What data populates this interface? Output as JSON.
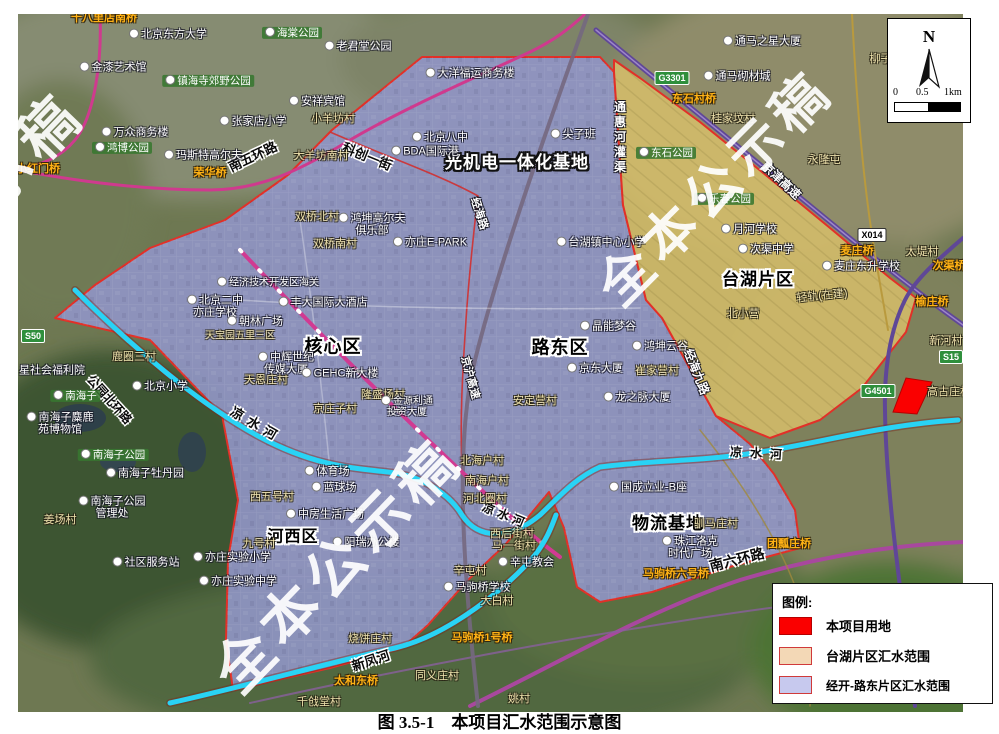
{
  "figure": {
    "caption": "图 3.5-1　本项目汇水范围示意图"
  },
  "map": {
    "scale": {
      "north": "N",
      "ticks": [
        "0",
        "0.5",
        "1km"
      ]
    },
    "legend": {
      "title": "图例:",
      "items": [
        {
          "label": "本项目用地",
          "color": "#fa0000",
          "border": "#b50000"
        },
        {
          "label": "台湖片区汇水范围",
          "color": "#f3d8b6",
          "border": "#d03a3a"
        },
        {
          "label": "经开-路东片区汇水范围",
          "color": "#c7c9ee",
          "border": "#d03a3a"
        }
      ]
    },
    "badges": [
      {
        "t": "S50",
        "x": 33,
        "y": 336,
        "c": "#2f8f3c",
        "tc": "#fff"
      },
      {
        "t": "G3301",
        "x": 672,
        "y": 78,
        "c": "#2f8f3c",
        "tc": "#fff"
      },
      {
        "t": "X014",
        "x": 872,
        "y": 235,
        "c": "#ffffff",
        "tc": "#000"
      },
      {
        "t": "G4501",
        "x": 878,
        "y": 391,
        "c": "#2f8f3c",
        "tc": "#fff"
      },
      {
        "t": "S15",
        "x": 951,
        "y": 357,
        "c": "#2f8f3c",
        "tc": "#fff"
      }
    ],
    "labels": [
      {
        "t": "光机电一体化基地",
        "x": 517,
        "y": 163,
        "s": "zonew",
        "fs": 17
      },
      {
        "t": "核心区",
        "x": 333,
        "y": 347,
        "s": "zone",
        "fs": 18
      },
      {
        "t": "路东区",
        "x": 560,
        "y": 348,
        "s": "zone",
        "fs": 18
      },
      {
        "t": "台湖片区",
        "x": 758,
        "y": 280,
        "s": "zone",
        "fs": 17
      },
      {
        "t": "河西区",
        "x": 293,
        "y": 537,
        "s": "zone",
        "fs": 16
      },
      {
        "t": "物流基地",
        "x": 668,
        "y": 524,
        "s": "zone",
        "fs": 17
      },
      {
        "t": "南五环路",
        "x": 253,
        "y": 157,
        "s": "road",
        "r": -25
      },
      {
        "t": "科创一街",
        "x": 367,
        "y": 157,
        "s": "road",
        "r": 22
      },
      {
        "t": "南六环路",
        "x": 737,
        "y": 560,
        "s": "road",
        "r": -14,
        "fs": 14
      },
      {
        "t": "公园北环路",
        "x": 109,
        "y": 400,
        "s": "road",
        "r": 48,
        "fs": 12
      },
      {
        "t": "新凤河",
        "x": 371,
        "y": 661,
        "s": "road",
        "r": -18
      },
      {
        "t": "凉水河",
        "x": 256,
        "y": 425,
        "s": "road",
        "r": 30,
        "ls": 6
      },
      {
        "t": "凉水河",
        "x": 505,
        "y": 516,
        "s": "road",
        "r": 22,
        "fs": 12,
        "ls": 4
      },
      {
        "t": "凉水河",
        "x": 760,
        "y": 454,
        "s": "road",
        "r": 3,
        "fs": 12,
        "ls": 8
      },
      {
        "t": "京津高速",
        "x": 781,
        "y": 181,
        "s": "roadw",
        "r": 43
      },
      {
        "t": "京沪高速",
        "x": 469,
        "y": 378,
        "s": "roadw",
        "r": 75,
        "fs": 11
      },
      {
        "t": "经海路",
        "x": 478,
        "y": 214,
        "s": "roadw",
        "r": 72,
        "fs": 11
      },
      {
        "t": "经海九路",
        "x": 696,
        "y": 372,
        "s": "roadw",
        "r": 68,
        "fs": 12
      },
      {
        "t": "通惠河灌渠",
        "x": 619,
        "y": 138,
        "s": "vroad",
        "fs": 12
      },
      {
        "t": "小红门桥",
        "x": 38,
        "y": 170,
        "s": "bridge"
      },
      {
        "t": "十八里店南桥",
        "x": 104,
        "y": 19,
        "s": "bridge"
      },
      {
        "t": "荣华桥",
        "x": 210,
        "y": 174,
        "s": "bridge"
      },
      {
        "t": "东石村桥",
        "x": 694,
        "y": 100,
        "s": "bridge"
      },
      {
        "t": "麦庄桥",
        "x": 857,
        "y": 252,
        "s": "bridge"
      },
      {
        "t": "次渠桥",
        "x": 949,
        "y": 267,
        "s": "bridge"
      },
      {
        "t": "榆庄桥",
        "x": 932,
        "y": 303,
        "s": "bridge"
      },
      {
        "t": "马驹桥1号桥",
        "x": 482,
        "y": 639,
        "s": "bridge"
      },
      {
        "t": "太和东桥",
        "x": 356,
        "y": 682,
        "s": "bridge"
      },
      {
        "t": "马驹桥六号桥",
        "x": 676,
        "y": 575,
        "s": "bridge"
      },
      {
        "t": "团瓢庄桥",
        "x": 789,
        "y": 545,
        "s": "bridge"
      },
      {
        "t": "小羊坊村",
        "x": 333,
        "y": 120,
        "s": "village"
      },
      {
        "t": "大羊坊南村",
        "x": 321,
        "y": 157,
        "s": "village"
      },
      {
        "t": "双桥北村",
        "x": 317,
        "y": 218,
        "s": "village"
      },
      {
        "t": "双桥南村",
        "x": 335,
        "y": 245,
        "s": "village"
      },
      {
        "t": "天宝园五里三区",
        "x": 240,
        "y": 337,
        "s": "village",
        "fs": 10
      },
      {
        "t": "天恩庄村",
        "x": 266,
        "y": 381,
        "s": "village"
      },
      {
        "t": "京庄子村",
        "x": 335,
        "y": 410,
        "s": "village"
      },
      {
        "t": "隆盛场村",
        "x": 383,
        "y": 396,
        "s": "village"
      },
      {
        "t": "崔家营村",
        "x": 657,
        "y": 372,
        "s": "village"
      },
      {
        "t": "安定营村",
        "x": 535,
        "y": 402,
        "s": "village"
      },
      {
        "t": "北海户村",
        "x": 482,
        "y": 462,
        "s": "village"
      },
      {
        "t": "南海户村",
        "x": 487,
        "y": 482,
        "s": "village"
      },
      {
        "t": "河北圈村",
        "x": 485,
        "y": 500,
        "s": "village"
      },
      {
        "t": "西后街村",
        "x": 512,
        "y": 535,
        "s": "village"
      },
      {
        "t": "马一街村",
        "x": 514,
        "y": 547,
        "s": "village"
      },
      {
        "t": "辛屯村",
        "x": 470,
        "y": 572,
        "s": "village"
      },
      {
        "t": "大白村",
        "x": 497,
        "y": 602,
        "s": "village"
      },
      {
        "t": "同义庄村",
        "x": 437,
        "y": 677,
        "s": "village"
      },
      {
        "t": "姚村",
        "x": 519,
        "y": 700,
        "s": "village"
      },
      {
        "t": "千戗堂村",
        "x": 319,
        "y": 703,
        "s": "village"
      },
      {
        "t": "烧饼庄村",
        "x": 370,
        "y": 640,
        "s": "village"
      },
      {
        "t": "西五号村",
        "x": 272,
        "y": 498,
        "s": "village"
      },
      {
        "t": "九号村",
        "x": 259,
        "y": 545,
        "s": "village"
      },
      {
        "t": "驯马庄村",
        "x": 716,
        "y": 525,
        "s": "village"
      },
      {
        "t": "桂家坟村",
        "x": 733,
        "y": 120,
        "s": "village"
      },
      {
        "t": "永隆屯",
        "x": 824,
        "y": 161,
        "s": "village"
      },
      {
        "t": "柳子村",
        "x": 886,
        "y": 60,
        "s": "village"
      },
      {
        "t": "太堤村",
        "x": 922,
        "y": 253,
        "s": "village"
      },
      {
        "t": "新河村",
        "x": 946,
        "y": 342,
        "s": "village"
      },
      {
        "t": "高古庄村",
        "x": 949,
        "y": 393,
        "s": "village"
      },
      {
        "t": "鹿圈三村",
        "x": 134,
        "y": 358,
        "s": "village"
      },
      {
        "t": "姜场村",
        "x": 60,
        "y": 521,
        "s": "village"
      },
      {
        "t": "北小营",
        "x": 743,
        "y": 315,
        "s": "village"
      },
      {
        "t": "轻轨(在建)",
        "x": 822,
        "y": 297,
        "s": "village",
        "r": -6
      },
      {
        "t": "北京东方大学",
        "x": 168,
        "y": 35,
        "s": "poi"
      },
      {
        "t": "金漆艺术馆",
        "x": 113,
        "y": 68,
        "s": "poi"
      },
      {
        "t": "安祥宾馆",
        "x": 317,
        "y": 102,
        "s": "poi"
      },
      {
        "t": "张家店小学",
        "x": 253,
        "y": 122,
        "s": "poi"
      },
      {
        "t": "万众商务楼",
        "x": 135,
        "y": 133,
        "s": "poi"
      },
      {
        "t": "玛斯特高尔夫",
        "x": 203,
        "y": 156,
        "s": "poi"
      },
      {
        "t": "老君堂公园",
        "x": 358,
        "y": 47,
        "s": "poi"
      },
      {
        "t": "大洋福运商务楼",
        "x": 470,
        "y": 74,
        "s": "poi"
      },
      {
        "t": "北京八中",
        "x": 440,
        "y": 138,
        "s": "poi"
      },
      {
        "t": "BDA国际港",
        "x": 425,
        "y": 152,
        "s": "poi"
      },
      {
        "t": "尖子班",
        "x": 573,
        "y": 135,
        "s": "poi"
      },
      {
        "t": "亦庄E·PARK",
        "x": 430,
        "y": 243,
        "s": "poi"
      },
      {
        "t": "鸿坤高尔夫\n俱乐部",
        "x": 372,
        "y": 225,
        "s": "poi"
      },
      {
        "t": "经济技术开发区海关",
        "x": 268,
        "y": 283,
        "s": "poi",
        "fs": 10
      },
      {
        "t": "北京二中\n亦庄学校",
        "x": 215,
        "y": 307,
        "s": "poi"
      },
      {
        "t": "朝林广场",
        "x": 255,
        "y": 322,
        "s": "poi"
      },
      {
        "t": "丰大国际大酒店",
        "x": 323,
        "y": 303,
        "s": "poi"
      },
      {
        "t": "中辉世纪\n传媒大厦",
        "x": 286,
        "y": 364,
        "s": "poi"
      },
      {
        "t": "GEHC新大楼",
        "x": 340,
        "y": 374,
        "s": "poi"
      },
      {
        "t": "金源利通\n投资大厦",
        "x": 407,
        "y": 407,
        "s": "poi",
        "fs": 10
      },
      {
        "t": "北京小学",
        "x": 160,
        "y": 387,
        "s": "poi"
      },
      {
        "t": "星社会福利院",
        "x": 46,
        "y": 371,
        "s": "poi"
      },
      {
        "t": "南海子麋鹿\n苑博物馆",
        "x": 60,
        "y": 424,
        "s": "poi"
      },
      {
        "t": "南海子牡丹园",
        "x": 145,
        "y": 474,
        "s": "poi"
      },
      {
        "t": "南海子公园\n管理处",
        "x": 112,
        "y": 508,
        "s": "poi"
      },
      {
        "t": "体育场",
        "x": 327,
        "y": 472,
        "s": "poi"
      },
      {
        "t": "蓝球场",
        "x": 334,
        "y": 488,
        "s": "poi"
      },
      {
        "t": "中房生活广场",
        "x": 325,
        "y": 515,
        "s": "poi"
      },
      {
        "t": "阳瑞办公楼",
        "x": 366,
        "y": 543,
        "s": "poi"
      },
      {
        "t": "社区服务站",
        "x": 146,
        "y": 563,
        "s": "poi"
      },
      {
        "t": "亦庄实验小学",
        "x": 232,
        "y": 558,
        "s": "poi"
      },
      {
        "t": "亦庄实验中学",
        "x": 238,
        "y": 582,
        "s": "poi"
      },
      {
        "t": "马驹桥学校",
        "x": 477,
        "y": 588,
        "s": "poi"
      },
      {
        "t": "辛屯教会",
        "x": 526,
        "y": 563,
        "s": "poi"
      },
      {
        "t": "晶能梦谷",
        "x": 608,
        "y": 327,
        "s": "poi"
      },
      {
        "t": "鸿坤云谷",
        "x": 660,
        "y": 347,
        "s": "poi"
      },
      {
        "t": "京东大厦",
        "x": 595,
        "y": 369,
        "s": "poi"
      },
      {
        "t": "龙之脉大厦",
        "x": 637,
        "y": 398,
        "s": "poi"
      },
      {
        "t": "国成立业-B座",
        "x": 648,
        "y": 488,
        "s": "poi"
      },
      {
        "t": "珠江洛克\n时代广场",
        "x": 690,
        "y": 548,
        "s": "poi"
      },
      {
        "t": "通马之星大厦",
        "x": 762,
        "y": 42,
        "s": "poi"
      },
      {
        "t": "通马砌材城",
        "x": 737,
        "y": 77,
        "s": "poi"
      },
      {
        "t": "月河学校",
        "x": 749,
        "y": 230,
        "s": "poi"
      },
      {
        "t": "次渠中学",
        "x": 766,
        "y": 250,
        "s": "poi"
      },
      {
        "t": "台湖镇中心小学",
        "x": 601,
        "y": 243,
        "s": "poi"
      },
      {
        "t": "麦庄东升学校",
        "x": 861,
        "y": 267,
        "s": "poi"
      },
      {
        "t": "海棠公园",
        "x": 292,
        "y": 33,
        "s": "green"
      },
      {
        "t": "镇海寺郊野公园",
        "x": 208,
        "y": 81,
        "s": "green"
      },
      {
        "t": "鸿博公园",
        "x": 122,
        "y": 148,
        "s": "green"
      },
      {
        "t": "南海子",
        "x": 75,
        "y": 396,
        "s": "green"
      },
      {
        "t": "南海子公园",
        "x": 113,
        "y": 455,
        "s": "green"
      },
      {
        "t": "东石公园",
        "x": 666,
        "y": 153,
        "s": "green"
      },
      {
        "t": "乐春公园",
        "x": 724,
        "y": 199,
        "s": "green"
      },
      {
        "t": "全本公示稿",
        "x": 338,
        "y": 566,
        "s": "wm",
        "r": -46,
        "fs": 58,
        "ls": 7
      },
      {
        "t": "全本公示稿",
        "x": 715,
        "y": 188,
        "s": "wm",
        "r": -45,
        "fs": 54,
        "ls": 7
      },
      {
        "t": "示稿",
        "x": 28,
        "y": 150,
        "s": "wm",
        "r": -46,
        "fs": 58,
        "ls": 7
      }
    ]
  }
}
